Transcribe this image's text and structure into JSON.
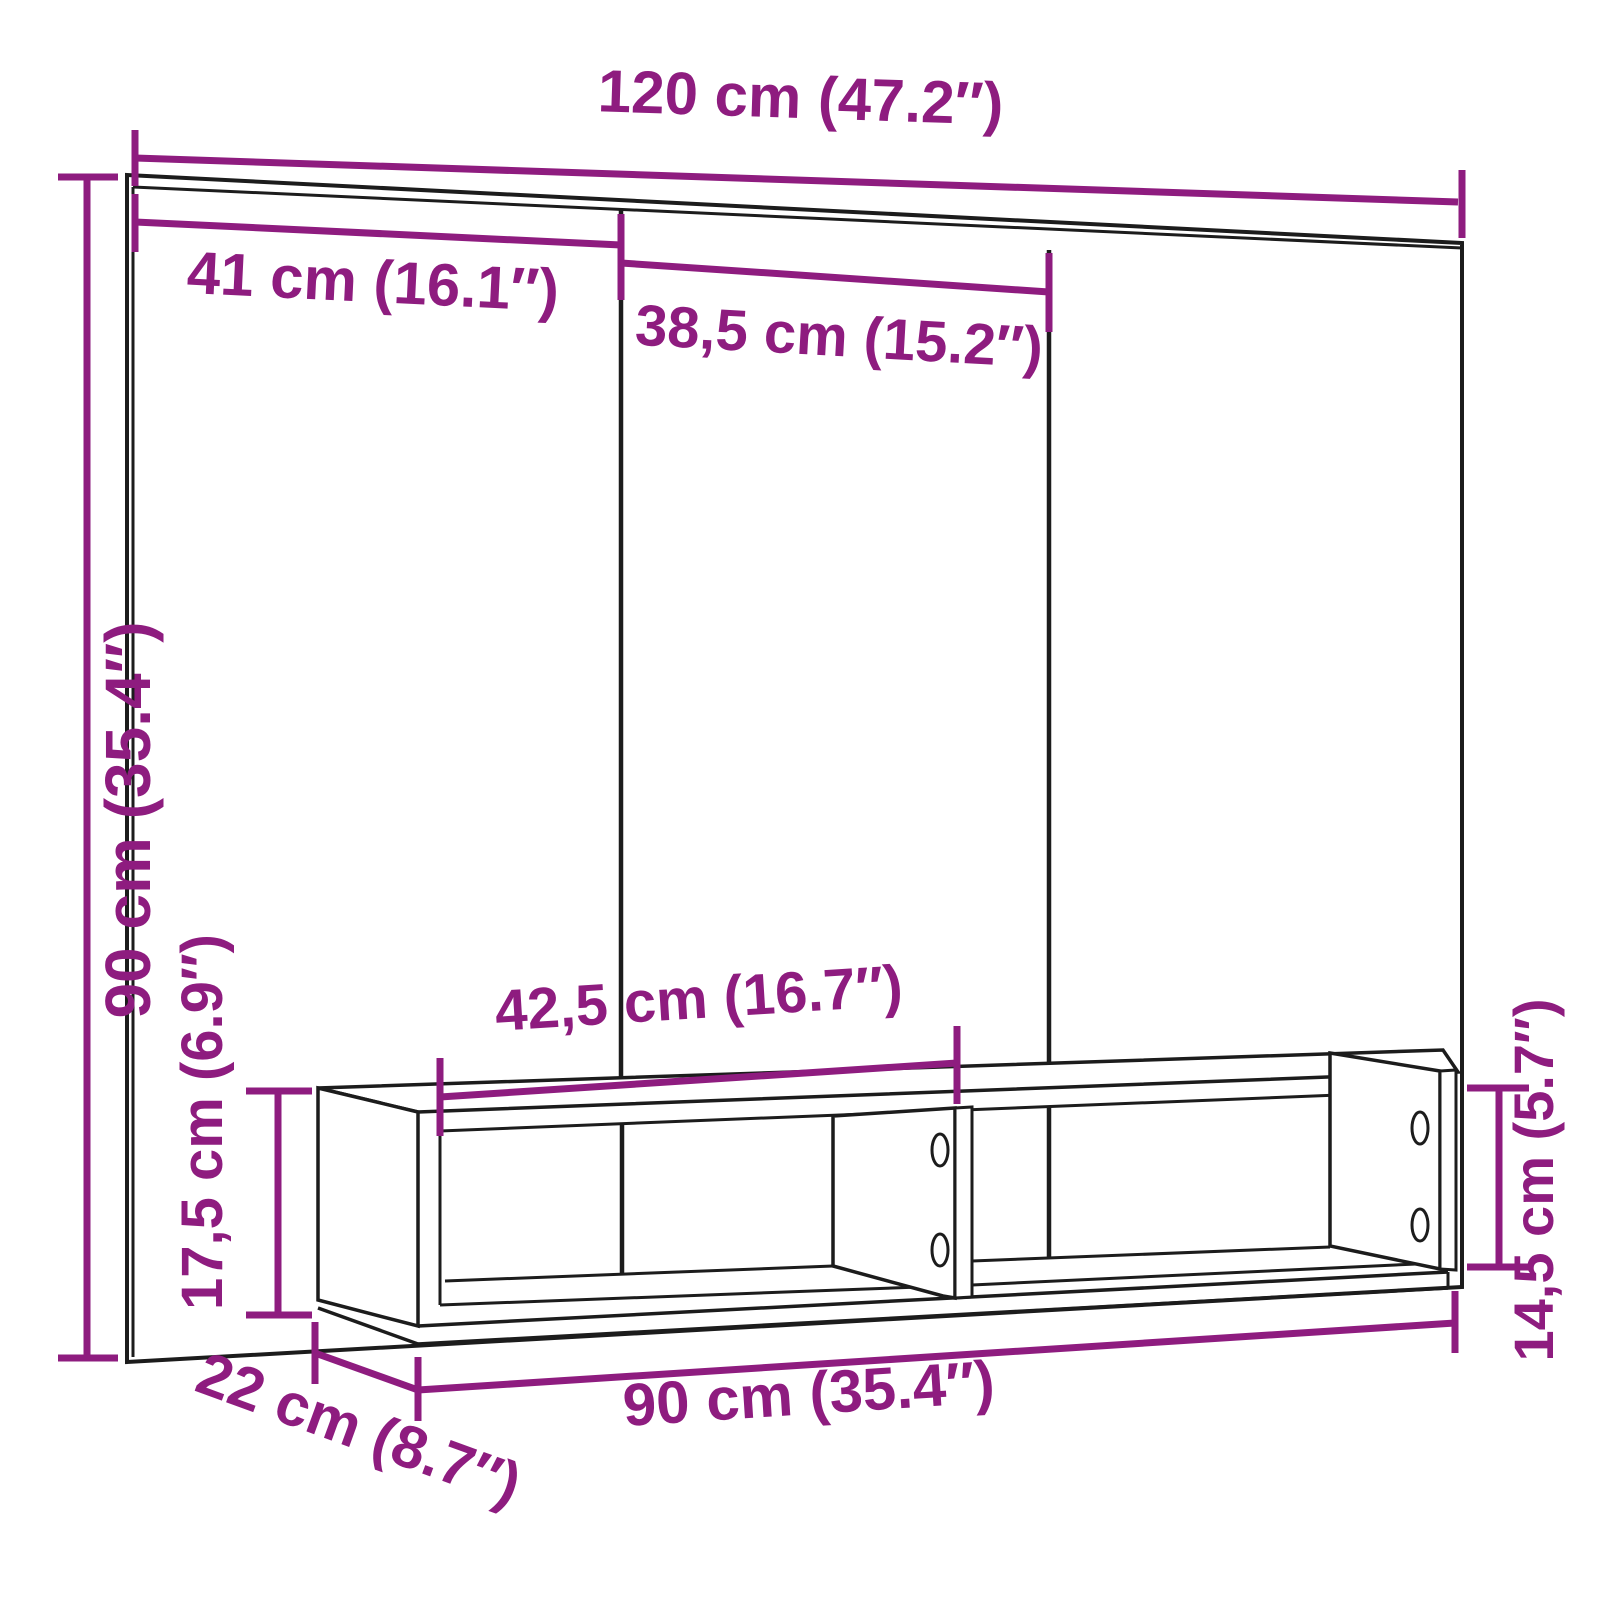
{
  "page": {
    "background": "#ffffff",
    "description": "Technical dimension diagram of a wall-mounted cabinet (mirror-front panel with three sections) with an open two-compartment shelf unit below"
  },
  "colors": {
    "dimension_accent": "#8E1C7F",
    "drawing_line": "#1C1C1C"
  },
  "diagram": {
    "dimensions": {
      "total_width": {
        "label": "120 cm (47.2″)",
        "value_cm": 120,
        "value_in": 47.2
      },
      "left_section_width": {
        "label": "41 cm (16.1″)",
        "value_cm": 41,
        "value_in": 16.1
      },
      "middle_section_width": {
        "label": "38,5 cm (15.2″)",
        "value_cm": 38.5,
        "value_in": 15.2
      },
      "overall_height": {
        "label": "90 cm (35.4″)",
        "value_cm": 90,
        "value_in": 35.4
      },
      "compartment_width": {
        "label": "42,5 cm (16.7″)",
        "value_cm": 42.5,
        "value_in": 16.7
      },
      "shelf_outer_height": {
        "label": "17,5 cm (6.9″)",
        "value_cm": 17.5,
        "value_in": 6.9
      },
      "shelf_inner_height": {
        "label": "14,5 cm (5.7″)",
        "value_cm": 14.5,
        "value_in": 5.7
      },
      "shelf_width": {
        "label": "90 cm (35.4″)",
        "value_cm": 90,
        "value_in": 35.4
      },
      "shelf_depth": {
        "label": "22 cm (8.7″)",
        "value_cm": 22,
        "value_in": 8.7
      }
    }
  }
}
